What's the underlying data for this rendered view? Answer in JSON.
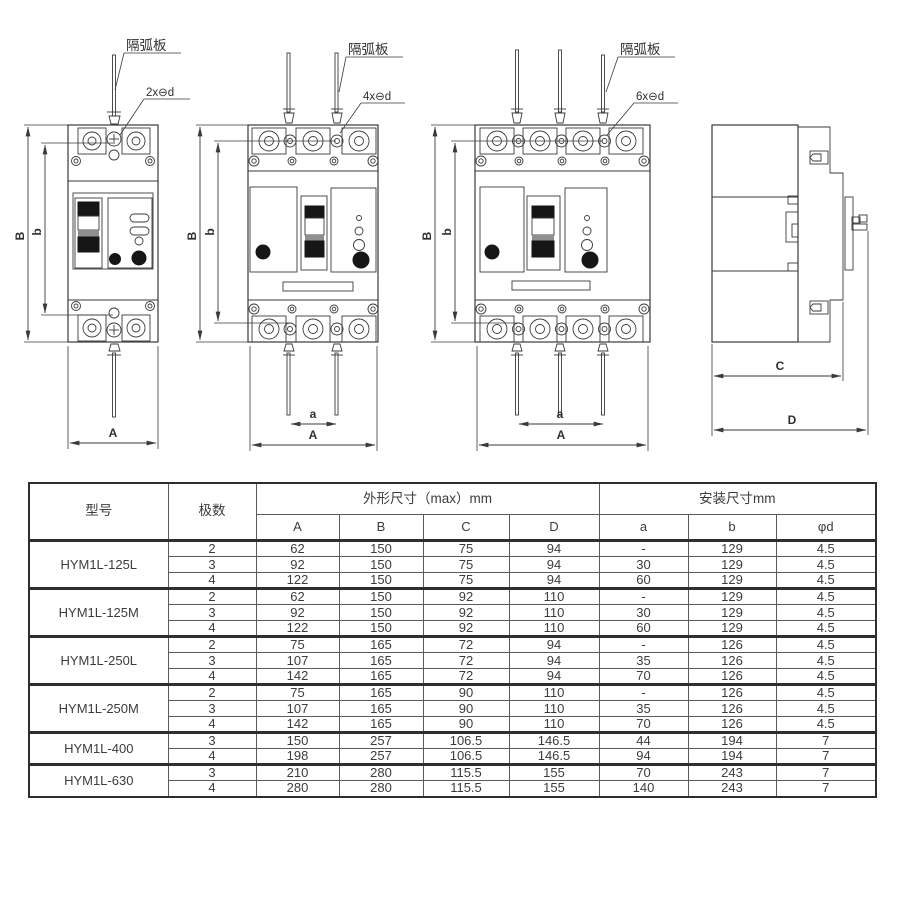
{
  "drawings": {
    "front_2pole": {
      "arc_plate_label": "隔弧板",
      "holes_label": "2x⊖d",
      "dims": {
        "B": "B",
        "b": "b",
        "A": "A"
      }
    },
    "front_3pole": {
      "arc_plate_label": "隔弧板",
      "holes_label": "4x⊖d",
      "dims": {
        "B": "B",
        "b": "b",
        "a": "a",
        "A": "A"
      }
    },
    "front_4pole": {
      "arc_plate_label": "隔弧板",
      "holes_label": "6x⊖d",
      "dims": {
        "B": "B",
        "b": "b",
        "a": "a",
        "A": "A"
      }
    },
    "side_view": {
      "dims": {
        "C": "C",
        "D": "D"
      }
    }
  },
  "table": {
    "header_model": "型号",
    "header_poles": "极数",
    "group_outline": "外形尺寸（max）mm",
    "group_mount": "安装尺寸mm",
    "sub_headers": [
      "A",
      "B",
      "C",
      "D",
      "a",
      "b",
      "φd"
    ],
    "groups": [
      {
        "model": "HYM1L-125L",
        "rows": [
          [
            "2",
            "62",
            "150",
            "75",
            "94",
            "-",
            "129",
            "4.5"
          ],
          [
            "3",
            "92",
            "150",
            "75",
            "94",
            "30",
            "129",
            "4.5"
          ],
          [
            "4",
            "122",
            "150",
            "75",
            "94",
            "60",
            "129",
            "4.5"
          ]
        ]
      },
      {
        "model": "HYM1L-125M",
        "rows": [
          [
            "2",
            "62",
            "150",
            "92",
            "110",
            "-",
            "129",
            "4.5"
          ],
          [
            "3",
            "92",
            "150",
            "92",
            "110",
            "30",
            "129",
            "4.5"
          ],
          [
            "4",
            "122",
            "150",
            "92",
            "110",
            "60",
            "129",
            "4.5"
          ]
        ]
      },
      {
        "model": "HYM1L-250L",
        "rows": [
          [
            "2",
            "75",
            "165",
            "72",
            "94",
            "-",
            "126",
            "4.5"
          ],
          [
            "3",
            "107",
            "165",
            "72",
            "94",
            "35",
            "126",
            "4.5"
          ],
          [
            "4",
            "142",
            "165",
            "72",
            "94",
            "70",
            "126",
            "4.5"
          ]
        ]
      },
      {
        "model": "HYM1L-250M",
        "rows": [
          [
            "2",
            "75",
            "165",
            "90",
            "110",
            "-",
            "126",
            "4.5"
          ],
          [
            "3",
            "107",
            "165",
            "90",
            "110",
            "35",
            "126",
            "4.5"
          ],
          [
            "4",
            "142",
            "165",
            "90",
            "110",
            "70",
            "126",
            "4.5"
          ]
        ]
      },
      {
        "model": "HYM1L-400",
        "rows": [
          [
            "3",
            "150",
            "257",
            "106.5",
            "146.5",
            "44",
            "194",
            "7"
          ],
          [
            "4",
            "198",
            "257",
            "106.5",
            "146.5",
            "94",
            "194",
            "7"
          ]
        ]
      },
      {
        "model": "HYM1L-630",
        "rows": [
          [
            "3",
            "210",
            "280",
            "115.5",
            "155",
            "70",
            "243",
            "7"
          ],
          [
            "4",
            "280",
            "280",
            "115.5",
            "155",
            "140",
            "243",
            "7"
          ]
        ]
      }
    ]
  },
  "colors": {
    "line": "#3a3a3a",
    "dark_fill": "#161616",
    "text": "#3c3c3c"
  }
}
